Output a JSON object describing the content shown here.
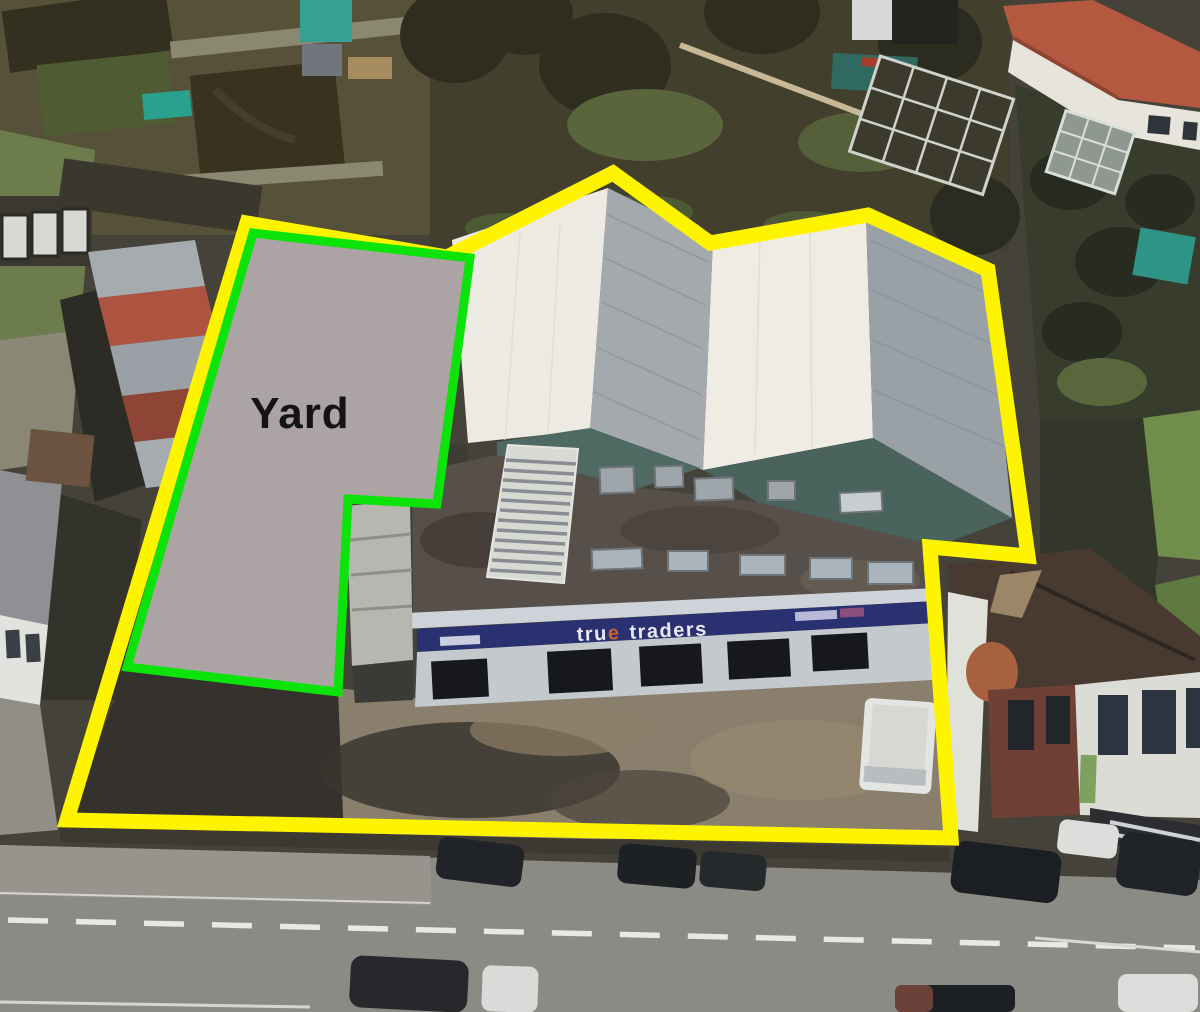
{
  "annotations": {
    "boundary": {
      "points": "247,223 447,257 613,173 710,243 868,215 988,270 1028,556 930,547 951,838 67,820",
      "color": "#FEF400",
      "width": "15"
    },
    "yard": {
      "label": "Yard",
      "points": "253,233 470,258 437,504 348,499 338,692 127,667",
      "fill": "#ABA3A4",
      "outline_color": "#0BE30B",
      "outline_width": "9",
      "label_color": "#141414"
    },
    "sign": {
      "word1": "tru",
      "accent": "e",
      "word2": "traders",
      "text_color": "#E8E9F3",
      "accent_color": "#D06030",
      "band_color": "#2A3070"
    }
  }
}
